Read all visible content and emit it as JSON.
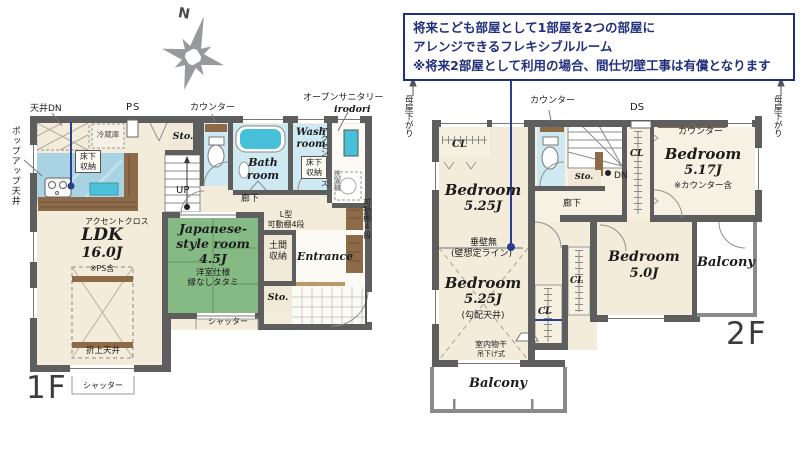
{
  "callout": {
    "line1": "将来こども部屋として1部屋を2つの部屋に",
    "line2": "アレンジできるフレキシブルルーム",
    "line3": "※将来2部屋として利用の場合、間仕切壁工事は有償となります"
  },
  "compass": {
    "north": "N"
  },
  "f1": {
    "floor": "1F",
    "tenjo_dn": "天井DN",
    "ps": "PS",
    "counter": "カウンター",
    "open_sanitary": "オープンサニタリー",
    "irodori": "irodori",
    "popup_ceiling": "ポップアップ天井",
    "fridge": "冷蔵庫",
    "floor_storage_k": "床下\n収納",
    "sto_upper": "Sto.",
    "up": "UP",
    "bath": "Bath\nroom",
    "wash": "Wash\nroom",
    "accent_cloth_wet": "アクセントクロス",
    "floor_storage_w": "床下\n収納",
    "washer": "洗濯機",
    "shelf_right": "可動棚4段",
    "hallway": "廊下",
    "l_shelf": "L型\n可動棚4段",
    "accent_cloth_ldk": "アクセントクロス",
    "ldk": "LDK",
    "ldk_size": "16.0J",
    "ldk_note": "※PS含",
    "coffered": "折上天井",
    "jp1": "Japanese-",
    "jp2": "style room",
    "jp_size": "4.5J",
    "jp_note1": "洋室仕様",
    "jp_note2": "縁なしタタミ",
    "doma": "土間\n収納",
    "entrance": "Entrance",
    "sto_lower": "Sto.",
    "shutter_a": "シャッター",
    "shutter_b": "シャッター"
  },
  "f2": {
    "floor": "2F",
    "moya_left": "母屋下がり",
    "moya_right": "母屋下がり",
    "counter_toilet": "カウンター",
    "ds": "DS",
    "counter_bed": "カウンター",
    "cl1": "CL",
    "bed1": "Bedroom",
    "bed1_size": "5.25J",
    "nowall1": "垂壁無",
    "nowall2": "(壁想定ライン)",
    "bed2": "Bedroom",
    "bed2_size": "5.25J",
    "bed2_note": "(勾配天井)",
    "cl2": "CL",
    "cl3": "CL",
    "sto": "Sto.",
    "dn": "DN",
    "hallway": "廊下",
    "cl4": "CL",
    "bed3": "Bedroom",
    "bed3_size": "5.17J",
    "bed3_note": "※カウンター含",
    "bed4": "Bedroom",
    "bed4_size": "5.0J",
    "balcony_r": "Balcony",
    "balcony_b": "Balcony",
    "drying1": "室内物干",
    "drying2": "吊下げ式"
  }
}
